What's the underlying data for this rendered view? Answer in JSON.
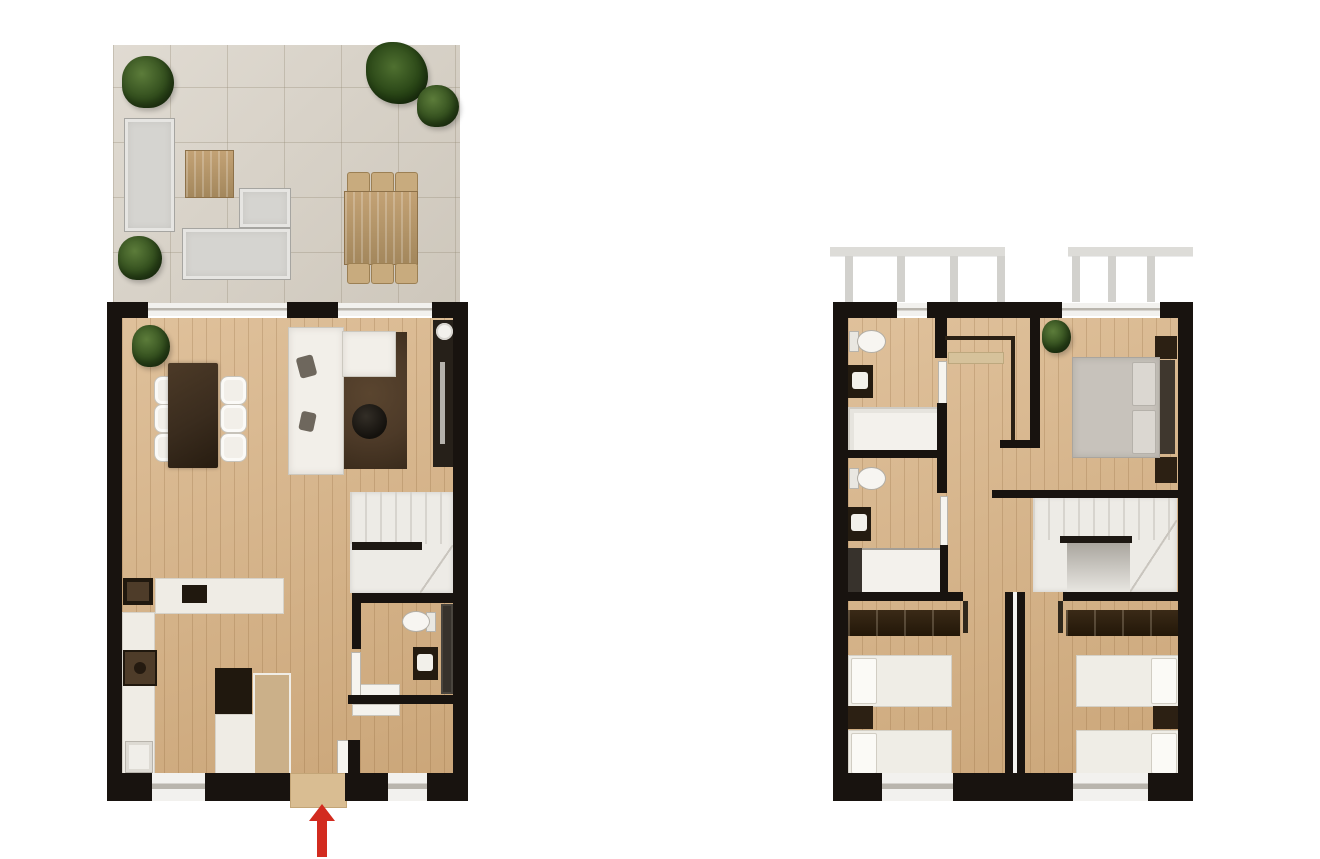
{
  "page": {
    "title": "Two-storey house floor plan",
    "background": "#ffffff"
  },
  "colors": {
    "bg": "#ffffff",
    "wall": "#18130f",
    "wood": "#d8b385",
    "terrace": "#d6cfc3",
    "white": "#f2efe9",
    "grey": "#d5d4d0",
    "outwood": "#b7976a",
    "darktable": "#3a2c1e",
    "rug": "#4d3a28",
    "stair": "#edebe6",
    "stairline": "#d7d4ce",
    "darkunit": "#241b10",
    "counter": "#efece5",
    "bedgrey": "#c7c2bb",
    "wardrobe": "#2c1f10",
    "plantlight": "#5c7c3a",
    "plantdark": "#2c4719",
    "red": "#d22b1f",
    "window": "#f2f1ee",
    "windowline": "#b9b5ad"
  },
  "plans": [
    {
      "id": "ground-floor",
      "label": "Ground floor with terrace",
      "rooms": [
        "terrace",
        "living-dining-room",
        "kitchen",
        "hallway",
        "wc",
        "staircase"
      ],
      "furniture": {
        "terrace": [
          "corner-lounge-sofa",
          "lounge-sofa",
          "wood-coffee-table",
          "side-table",
          "outdoor-dining-table",
          "6-outdoor-chairs",
          "4-plants"
        ],
        "living_dining": [
          "dining-table",
          "6-chairs",
          "corner-sofa",
          "2-throw-pillows",
          "rug",
          "round-coffee-table",
          "tv-unit",
          "floor-lamp",
          "plant"
        ],
        "kitchen": [
          "island-counter",
          "wall-counter",
          "sink",
          "cooktop",
          "tall-cabinet",
          "cabinet-door"
        ],
        "wc": [
          "toilet",
          "washbasin",
          "radiator-panel"
        ],
        "hallway": [
          "bench",
          "entrance-door"
        ]
      },
      "entrance": {
        "marker": "red-arrow",
        "direction": "up",
        "location": "bottom-center"
      }
    },
    {
      "id": "first-floor",
      "label": "First floor",
      "rooms": [
        "bathroom-1",
        "bathroom-2",
        "master-bedroom",
        "bedroom-2",
        "bedroom-3",
        "landing",
        "staircase",
        "balcony"
      ],
      "furniture": {
        "bathroom_1": [
          "toilet",
          "washbasin",
          "bathtub"
        ],
        "bathroom_2": [
          "toilet",
          "washbasin",
          "shower"
        ],
        "master_bedroom": [
          "double-bed",
          "headboard-wardrobe",
          "2-nightstands",
          "closet",
          "plant"
        ],
        "bedroom_2": [
          "2-single-beds",
          "wardrobe",
          "nightstand"
        ],
        "bedroom_3": [
          "2-single-beds",
          "wardrobe",
          "nightstand"
        ],
        "balcony": [
          "2-railing-sections"
        ]
      }
    }
  ]
}
